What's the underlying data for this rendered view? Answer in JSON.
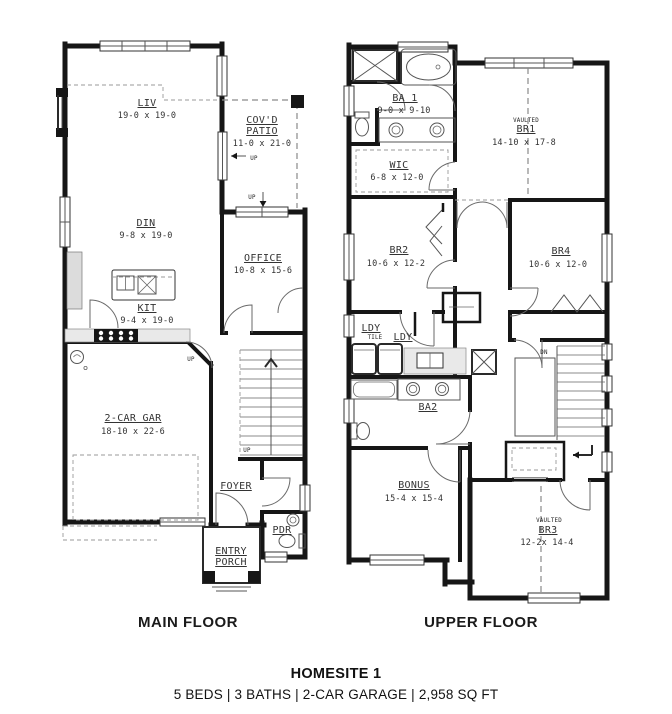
{
  "footer": {
    "title": "HOMESITE 1",
    "specs": "5 BEDS | 3 BATHS | 2-CAR GARAGE | 2,958 SQ FT"
  },
  "main_floor": {
    "caption": "MAIN FLOOR",
    "rooms": {
      "liv": {
        "name": "LIV",
        "dims": "19-0 x 19-0"
      },
      "patio": {
        "name1": "COV'D",
        "name2": "PATIO",
        "dims": "11-0 x 21-0"
      },
      "din": {
        "name": "DIN",
        "dims": "9-8 x 19-0"
      },
      "office": {
        "name": "OFFICE",
        "dims": "10-8 x 15-6"
      },
      "kit": {
        "name": "KIT",
        "dims": "9-4 x 19-0"
      },
      "gar": {
        "name": "2-CAR GAR",
        "dims": "18-10 x 22-6"
      },
      "foyer": {
        "name": "FOYER"
      },
      "pdr": {
        "name": "PDR"
      },
      "porch": {
        "name1": "ENTRY",
        "name2": "PORCH"
      }
    },
    "notes": {
      "up": "UP"
    }
  },
  "upper_floor": {
    "caption": "UPPER FLOOR",
    "rooms": {
      "ba1": {
        "name": "BA 1",
        "dims": "9-0 x 9-10"
      },
      "br1": {
        "prefix": "VAULTED",
        "name": "BR1",
        "dims": "14-10 x 17-8"
      },
      "wic": {
        "name": "WIC",
        "dims": "6-8 x 12-0"
      },
      "br2": {
        "name": "BR2",
        "dims": "10-6 x 12-2"
      },
      "br4": {
        "name": "BR4",
        "dims": "10-6 x 12-0"
      },
      "ldy1": {
        "name": "LDY",
        "sub": "TILE"
      },
      "ldy2": {
        "name": "LDY"
      },
      "ba2": {
        "name": "BA2"
      },
      "bonus": {
        "name": "BONUS",
        "dims": "15-4 x 15-4"
      },
      "br3": {
        "prefix": "VAULTED",
        "name": "BR3",
        "dims": "12-2x 14-4"
      }
    },
    "notes": {
      "dn": "DN"
    }
  }
}
